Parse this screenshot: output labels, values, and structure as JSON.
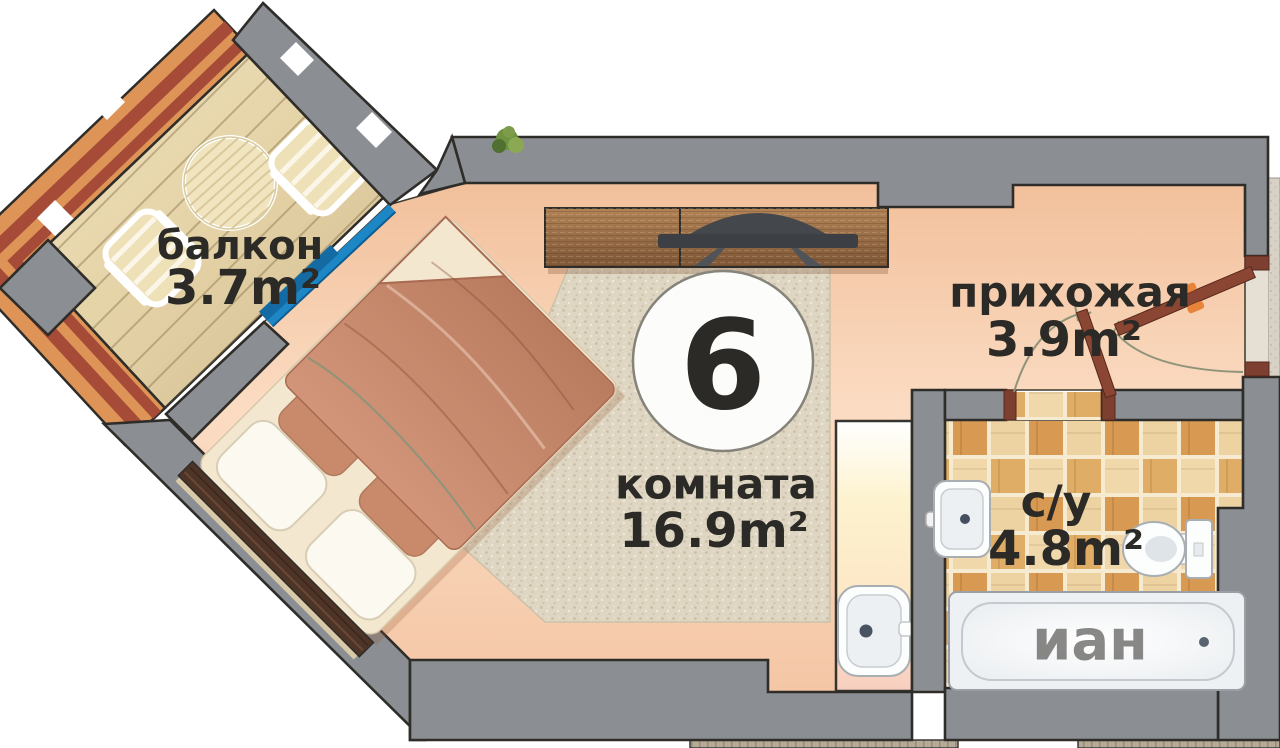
{
  "plan": {
    "type": "apartment-floor-plan",
    "apartment_number": "6",
    "rooms": [
      {
        "id": "balcony",
        "label": "балкон",
        "area": "3.7m²"
      },
      {
        "id": "room",
        "label": "комната",
        "area": "16.9m²"
      },
      {
        "id": "hallway",
        "label": "прихожая",
        "area": "3.9m²"
      },
      {
        "id": "bathroom",
        "label": "с/у",
        "area": "4.8m²"
      }
    ],
    "watermark": "иан",
    "colors": {
      "wall": "#8b8e92",
      "wall_outline": "#2e2d29",
      "floor_peach": "#f8d2b4",
      "rug": "#ded6c2",
      "balcony_frame": "#de9456",
      "balcony_frame_stripe": "#a54b37",
      "balcony_wood": "#e8d8b2",
      "balcony_door_blue": "#1d87c6",
      "door_brown": "#8a4632",
      "door_handle_orange": "#e8833a",
      "tile_dark": "#d89a52",
      "tile_light": "#f0d8ab",
      "bed_blanket": "#c58a6d",
      "bed_sheet": "#f3e7cf",
      "headboard": "#4e3427",
      "cabinet_wood": "#9c6f47",
      "tv_dark": "#3c4044",
      "plant_green": "#6b8f3f"
    }
  }
}
